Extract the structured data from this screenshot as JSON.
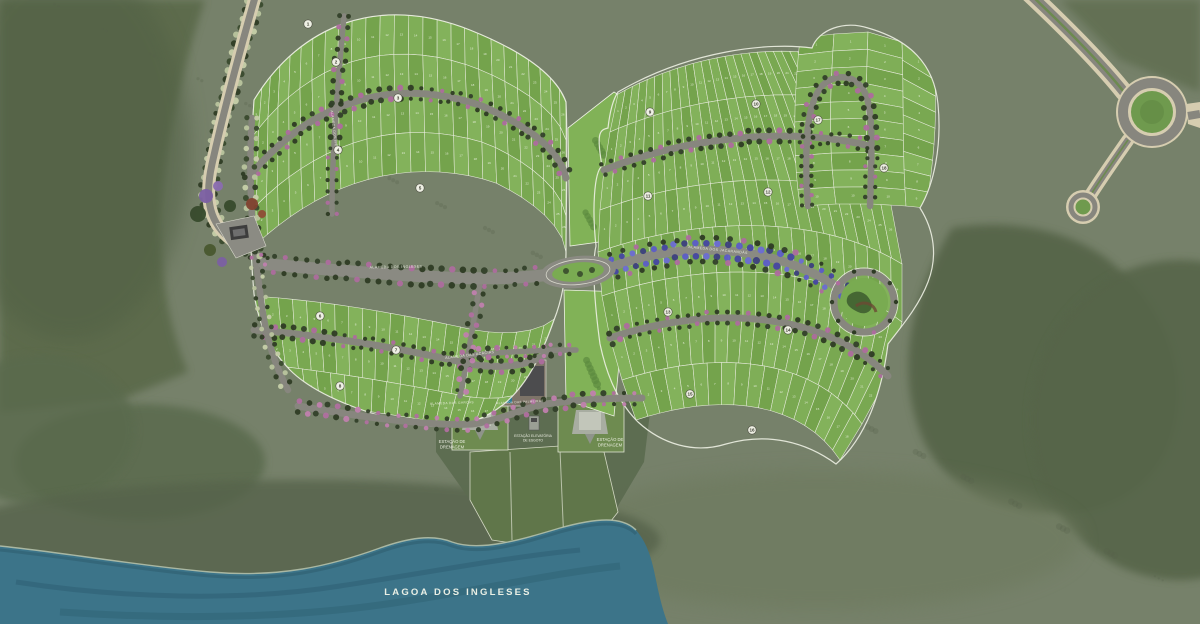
{
  "labels": {
    "lagoon": "LAGOA DOS INGLESES",
    "drainage_left_1": "ESTAÇÃO DE",
    "drainage_left_2": "DRENAGEM",
    "drainage_right_1": "ESTAÇÃO DE",
    "drainage_right_2": "DRENAGEM",
    "pump_1": "ESTAÇÃO ELEVATÓRIA",
    "pump_2": "DE ESGOTO",
    "streets": [
      "ALAMEDA DOS INGLESES",
      "ALAMEDA DAS ACÁCIAS",
      "ALAMEDA DOS JACARANDÁS",
      "ALAMEDA DAS GARÇAS",
      "ALAMEDA DOS IPÊS",
      "ALAMEDA DAS PALMEIRAS"
    ]
  },
  "colors": {
    "terrain_base": "#76816a",
    "terrain_dark": "#5b6a4c",
    "terrain_forest": "#566548",
    "shore_band": "#57644c",
    "water": "#3c7489",
    "water_dark": "#2e6174",
    "water_edge": "#b9c4ad",
    "lot_fills": [
      "#79a851",
      "#7fae57",
      "#74a34c",
      "#83b25b"
    ],
    "lot_line": "#e7ebdc",
    "lot_number": "#eef3e4",
    "park_green": "#81b257",
    "road": "#87867e",
    "avenue": "#8a8a82",
    "cream": "#d6cdb0",
    "median_green": "#6d8a50",
    "roundabout_green": "#6f9a4e",
    "boundary_white": "#edf0e3",
    "street_trees": [
      "#2e3b24",
      "#33402a",
      "#ad6c9e",
      "#2e3b24"
    ],
    "pink_trees": [
      "#b06fa0",
      "#2f3c25",
      "#c07fae",
      "#33402a"
    ],
    "purple_trees": [
      "#5c5cc8",
      "#4646a2",
      "#6c6cd4",
      "#3c3f7e"
    ],
    "blvd_trees": [
      "#c6cfa9",
      "#3a4a2e",
      "#b9c49e",
      "#2f3c25"
    ],
    "label_white": "#f0f2e6"
  },
  "left_cluster": {
    "boundary": "M254,100 C300,24 380,-6 470,30 C520,50 556,74 566,102 C568,150 566,200 566,252 C566,276 562,300 554,320 C542,354 528,384 504,404 C476,426 446,430 418,424 C378,418 318,398 290,370 C268,348 258,320 254,294 C248,228 250,158 254,100 Z",
    "edges": [
      "M254,100 C300,24 380,-6 470,30 C520,50 556,74 566,102",
      "M250,140 C304,64 384,34 476,68 C524,88 558,112 566,140",
      "M248,178 C308,104 390,74 482,106 C528,126 560,150 566,178",
      "M246,216 C312,144 396,114 488,144 C532,164 562,190 566,216",
      "M246,254 C316,184 402,154 494,182 C536,202 564,228 566,252",
      "M250,296 C330,300 420,318 474,330 C510,336 540,332 556,318",
      "M254,330 C334,336 418,352 470,364 C506,370 534,364 548,352",
      "M260,364 C336,372 414,386 464,396 C498,402 524,396 538,384",
      "M268,398 C340,406 410,418 452,424 C484,428 510,420 524,410"
    ],
    "bands": [
      {
        "t": 0,
        "b": 1,
        "n": 26
      },
      {
        "t": 1,
        "b": 2,
        "n": 26
      },
      {
        "t": 2,
        "b": 3,
        "n": 26
      },
      {
        "t": 3,
        "b": 4,
        "n": 26
      },
      {
        "t": 5,
        "b": 6,
        "n": 22
      },
      {
        "t": 6,
        "b": 7,
        "n": 22
      },
      {
        "t": 7,
        "b": 8,
        "n": 20
      }
    ],
    "street_edges": [
      2,
      6
    ]
  },
  "right_cluster": {
    "boundary": "M618,92 C690,50 770,42 812,48 C818,30 844,20 868,28 C910,40 934,64 938,104 C942,146 934,184 920,208 C934,230 938,256 928,282 C918,308 900,328 888,344 C882,392 866,438 836,464 C806,442 768,432 726,444 C694,454 662,444 638,422 C616,400 606,372 600,344 C594,300 592,262 596,246 C592,210 594,172 602,166 C596,132 600,130 608,128 C610,110 614,98 618,92 Z",
    "edges": [
      "M618,94 C690,54 768,46 822,54",
      "M610,132 C692,96 784,88 848,100",
      "M604,170 C694,134 798,128 870,146",
      "M600,210 C698,174 812,170 890,200",
      "M598,252 C706,214 824,216 902,264",
      "M602,296 C712,258 830,264 902,322",
      "M610,338 C718,302 828,314 888,376",
      "M622,380 C726,346 818,362 862,424",
      "M636,420 C734,388 806,408 840,460"
    ],
    "bands": [
      {
        "t": 0,
        "b": 1,
        "n": 26
      },
      {
        "t": 1,
        "b": 2,
        "n": 26
      },
      {
        "t": 2,
        "b": 3,
        "n": 26
      },
      {
        "t": 3,
        "b": 4,
        "n": 26
      },
      {
        "t": 4,
        "b": 5,
        "n": 24
      },
      {
        "t": 5,
        "b": 6,
        "n": 24
      },
      {
        "t": 6,
        "b": 7,
        "n": 22
      },
      {
        "t": 7,
        "b": 8,
        "n": 18
      }
    ],
    "street_edges": [
      2,
      6
    ]
  },
  "arm": {
    "edges": [
      "M800,38 C794,96 792,150 800,206",
      "M834,34 C830,94 828,148 836,204",
      "M868,32 C866,94 864,148 872,204",
      "M902,42 C904,98 902,150 906,206",
      "M934,64 C938,112 934,162 926,208"
    ],
    "bands": [
      {
        "t": 0,
        "b": 1,
        "n": 10
      },
      {
        "t": 1,
        "b": 2,
        "n": 10
      },
      {
        "t": 2,
        "b": 3,
        "n": 10
      },
      {
        "t": 3,
        "b": 4,
        "n": 9
      }
    ],
    "hairpin": "M808,206 C804,150 806,104 822,86 C834,74 852,74 862,88 C874,102 872,150 870,206"
  },
  "roads": {
    "avenue": "M264,264 C330,270 400,276 460,278 C502,279 530,277 546,275",
    "purple_road": "M614,266 C680,242 762,244 826,280 C846,292 856,298 862,304",
    "left_connector": "M252,118 C248,178 252,238 260,292 C264,330 274,364 288,390",
    "radial1": "M344,16 C338,80 332,150 332,214",
    "radial2": "M480,282 C474,320 468,358 460,396",
    "bottom_road": "M298,406 C380,420 440,426 472,424 C504,420 522,408 546,404 C574,400 606,398 642,398",
    "ete_street": "M462,356 C500,352 540,350 576,350",
    "access_road": "M256,-6 C240,50 224,110 212,164 C204,200 210,224 232,240",
    "boulevard_ne": "M1030,-6 C1066,28 1100,62 1124,92",
    "sw_spur": "M1128,140 C1114,160 1100,180 1090,196"
  },
  "parks": {
    "strip_upper": "M568,128 L614,92 C624,98 632,106 636,114 L628,238 L570,246 Z",
    "strip_lower": "M564,290 L626,292 L614,416 L566,400 Z",
    "circle_park": {
      "cx": 864,
      "cy": 302,
      "r_road": 30,
      "r_green": 24
    },
    "oval_roundabout": {
      "cx": 578,
      "cy": 272
    },
    "ne_roundabout": {
      "cx": 1152,
      "cy": 112
    },
    "culdesac": {
      "cx": 1083,
      "cy": 207
    }
  },
  "water": {
    "lagoon": "M0,624 L0,546 C60,552 140,566 210,572 C280,578 330,566 380,548 C408,538 432,534 452,542 C480,552 520,540 560,528 C596,518 622,516 636,530 C648,544 652,560 656,580 C660,600 664,614 668,624 Z",
    "shore_line": "M0,546 C60,552 140,566 210,572 C280,578 330,566 380,548 C408,538 432,534 452,542 C480,552 520,540 560,528 C596,518 622,516 636,530",
    "streak1": "M16,582 C120,598 240,602 340,586 C420,574 500,558 580,550",
    "streak2": "M60,612 C180,620 300,618 400,602 C480,590 560,572 620,566"
  },
  "quadras": [
    [
      308,
      24,
      "1"
    ],
    [
      336,
      62,
      "2"
    ],
    [
      398,
      98,
      "3"
    ],
    [
      338,
      150,
      "4"
    ],
    [
      420,
      188,
      "5"
    ],
    [
      320,
      316,
      "6"
    ],
    [
      396,
      350,
      "7"
    ],
    [
      340,
      386,
      "8"
    ],
    [
      650,
      112,
      "9"
    ],
    [
      756,
      104,
      "10"
    ],
    [
      648,
      196,
      "11"
    ],
    [
      768,
      192,
      "12"
    ],
    [
      668,
      312,
      "13"
    ],
    [
      788,
      330,
      "14"
    ],
    [
      690,
      394,
      "15"
    ],
    [
      752,
      430,
      "16"
    ],
    [
      818,
      120,
      "17"
    ],
    [
      884,
      168,
      "18"
    ]
  ]
}
